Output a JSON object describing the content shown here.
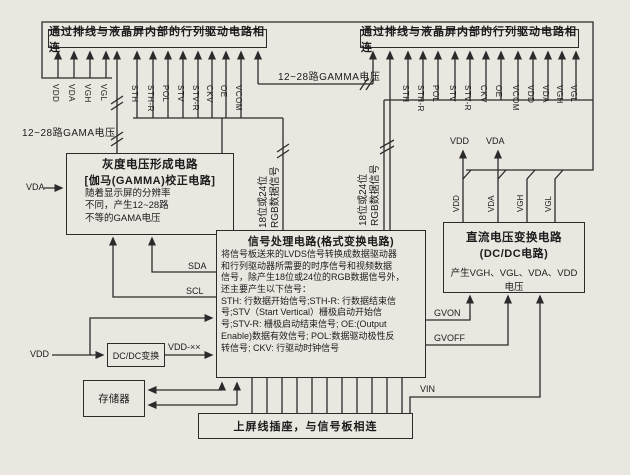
{
  "colors": {
    "background": "#e9e7e0",
    "line": "#2b2b2b",
    "text": "#1c1c1c"
  },
  "connectors": {
    "top_left": {
      "label": "通过排线与液晶屏内部的行列驱动电路相连"
    },
    "top_right": {
      "label": "通过排线与液晶屏内部的行列驱动电路相连"
    },
    "bottom": {
      "label": "上屏线插座，与信号板相连"
    }
  },
  "pins": {
    "left_power": [
      "VDD",
      "VDA",
      "VGH",
      "VGL"
    ],
    "left_signals": [
      "STH",
      "STH-R",
      "POL",
      "STV",
      "STV-R",
      "CKV",
      "OE",
      "VCOM"
    ],
    "right_signals": [
      "STH",
      "STH-R",
      "POL",
      "STV",
      "STV-R",
      "CKV",
      "OE",
      "VCOM",
      "VDD",
      "VDA",
      "VGH",
      "VGL"
    ],
    "dcdc_outputs": [
      "VDD",
      "VDA",
      "VGH",
      "VGL"
    ]
  },
  "blocks": {
    "gamma": {
      "title": "灰度电压形成电路",
      "subtitle": "[伽马(GAMMA)校正电路]",
      "body_lines": [
        "随着显示屏的分辨率",
        "不同，产生12~28路",
        "不等的GAMA电压"
      ]
    },
    "signal": {
      "title": "信号处理电路(格式变换电路)",
      "body_lines": [
        "将信号板送来的LVDS信号转换成数据驱动器",
        "和行列驱动器所需要的时序信号和视频数据",
        "信号，除产生18位或24位的RGB数据信号外，",
        "还主要产生以下信号：",
        "STH: 行数据开始信号;STH-R: 行数据结束信",
        "号;STV（Start Vertical）栅极启动开始信",
        "号;STV-R: 栅极启动结束信号; OE:(Output",
        "Enable)数据有效信号; POL:数据驱动极性反",
        "转信号; CKV: 行驱动时钟信号"
      ]
    },
    "dcdc": {
      "title": "直流电压变换电路",
      "subtitle": "(DC/DC电路)",
      "body": "产生VGH、VGL、VDA、VDD电压"
    },
    "dcdc_small": {
      "label": "DC/DC变换"
    },
    "memory": {
      "label": "存储器"
    }
  },
  "labels": {
    "gamma_bus_left": "12~28路GAMA电压",
    "gamma_bus_top": "12~28路GAMMA电压",
    "rgb_bus_left": "18位或24位\nRGB数据信号",
    "rgb_bus_right": "18位或24位\nRGB数据信号",
    "vda_in": "VDA",
    "vdd_in": "VDD",
    "vdd_xx": "VDD-××",
    "sda": "SDA",
    "scl": "SCL",
    "gvon": "GVON",
    "gvoff": "GVOFF",
    "vin": "VIN",
    "vdd_branch": "VDD",
    "vda_branch": "VDA"
  }
}
